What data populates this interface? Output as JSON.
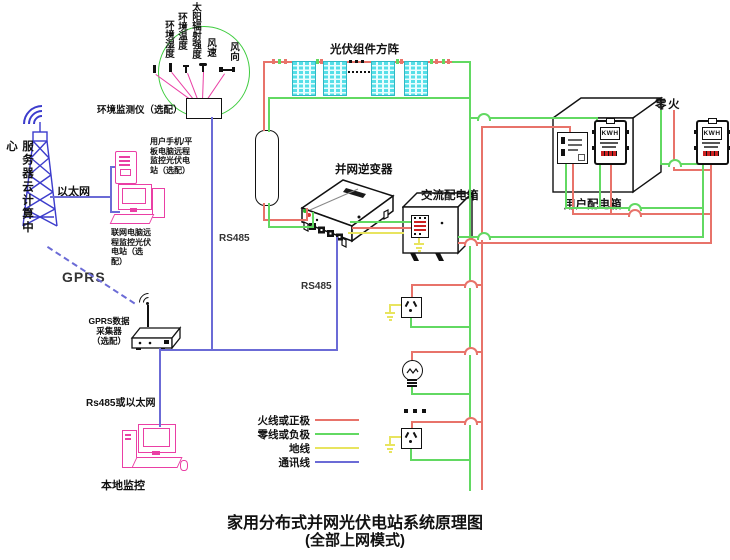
{
  "title": {
    "line1": "家用分布式并网光伏电站系统原理图",
    "line2": "(全部上网模式)"
  },
  "net": {
    "server_center": "服务器云计算中心",
    "ethernet": "以太网",
    "phone_note": "用户手机/平板电脑远程监控光伏电站（选配）",
    "pc_note": "联网电脑远程监控光伏电站（选配）",
    "gprs": "GPRS",
    "gprs_collector": "GPRS数据\n采集器\n（选配）",
    "rs485_or_eth": "Rs485或以太网",
    "local_monitor": "本地监控",
    "rs485_a": "RS485",
    "rs485_b": "RS485"
  },
  "env": {
    "label": "环境监测仪（选配）",
    "sensors": [
      "环境湿度",
      "环境温度",
      "太阳辐射强度",
      "风速",
      "风向"
    ]
  },
  "pv": {
    "array_label": "光伏组件方阵",
    "inverter_label": "并网逆变器"
  },
  "dist": {
    "ac_box_label": "交流配电箱",
    "user_box_label": "用户配电箱",
    "neutral_char": "零",
    "live_char": "火"
  },
  "meter": {
    "display": "KWH"
  },
  "legend": {
    "items": [
      {
        "label": "火线或正极",
        "color": "#e8736a"
      },
      {
        "label": "零线或负极",
        "color": "#62d962"
      },
      {
        "label": "地线",
        "color": "#e8e45f"
      },
      {
        "label": "通讯线",
        "color": "#6b6bd6"
      }
    ]
  },
  "colors": {
    "wire_live_red": "#e8736a",
    "wire_neutral_green": "#62d962",
    "wire_ground_yellow": "#e8e45f",
    "wire_comm_blue": "#6b6bd6",
    "monitor_magenta": "#ea3fa5",
    "pv_panel_cyan": "#55dfe8",
    "env_circle_green": "#3ecc3e",
    "tower_blue": "#3c3ccc",
    "meter_bar_red": "#cc2222"
  }
}
